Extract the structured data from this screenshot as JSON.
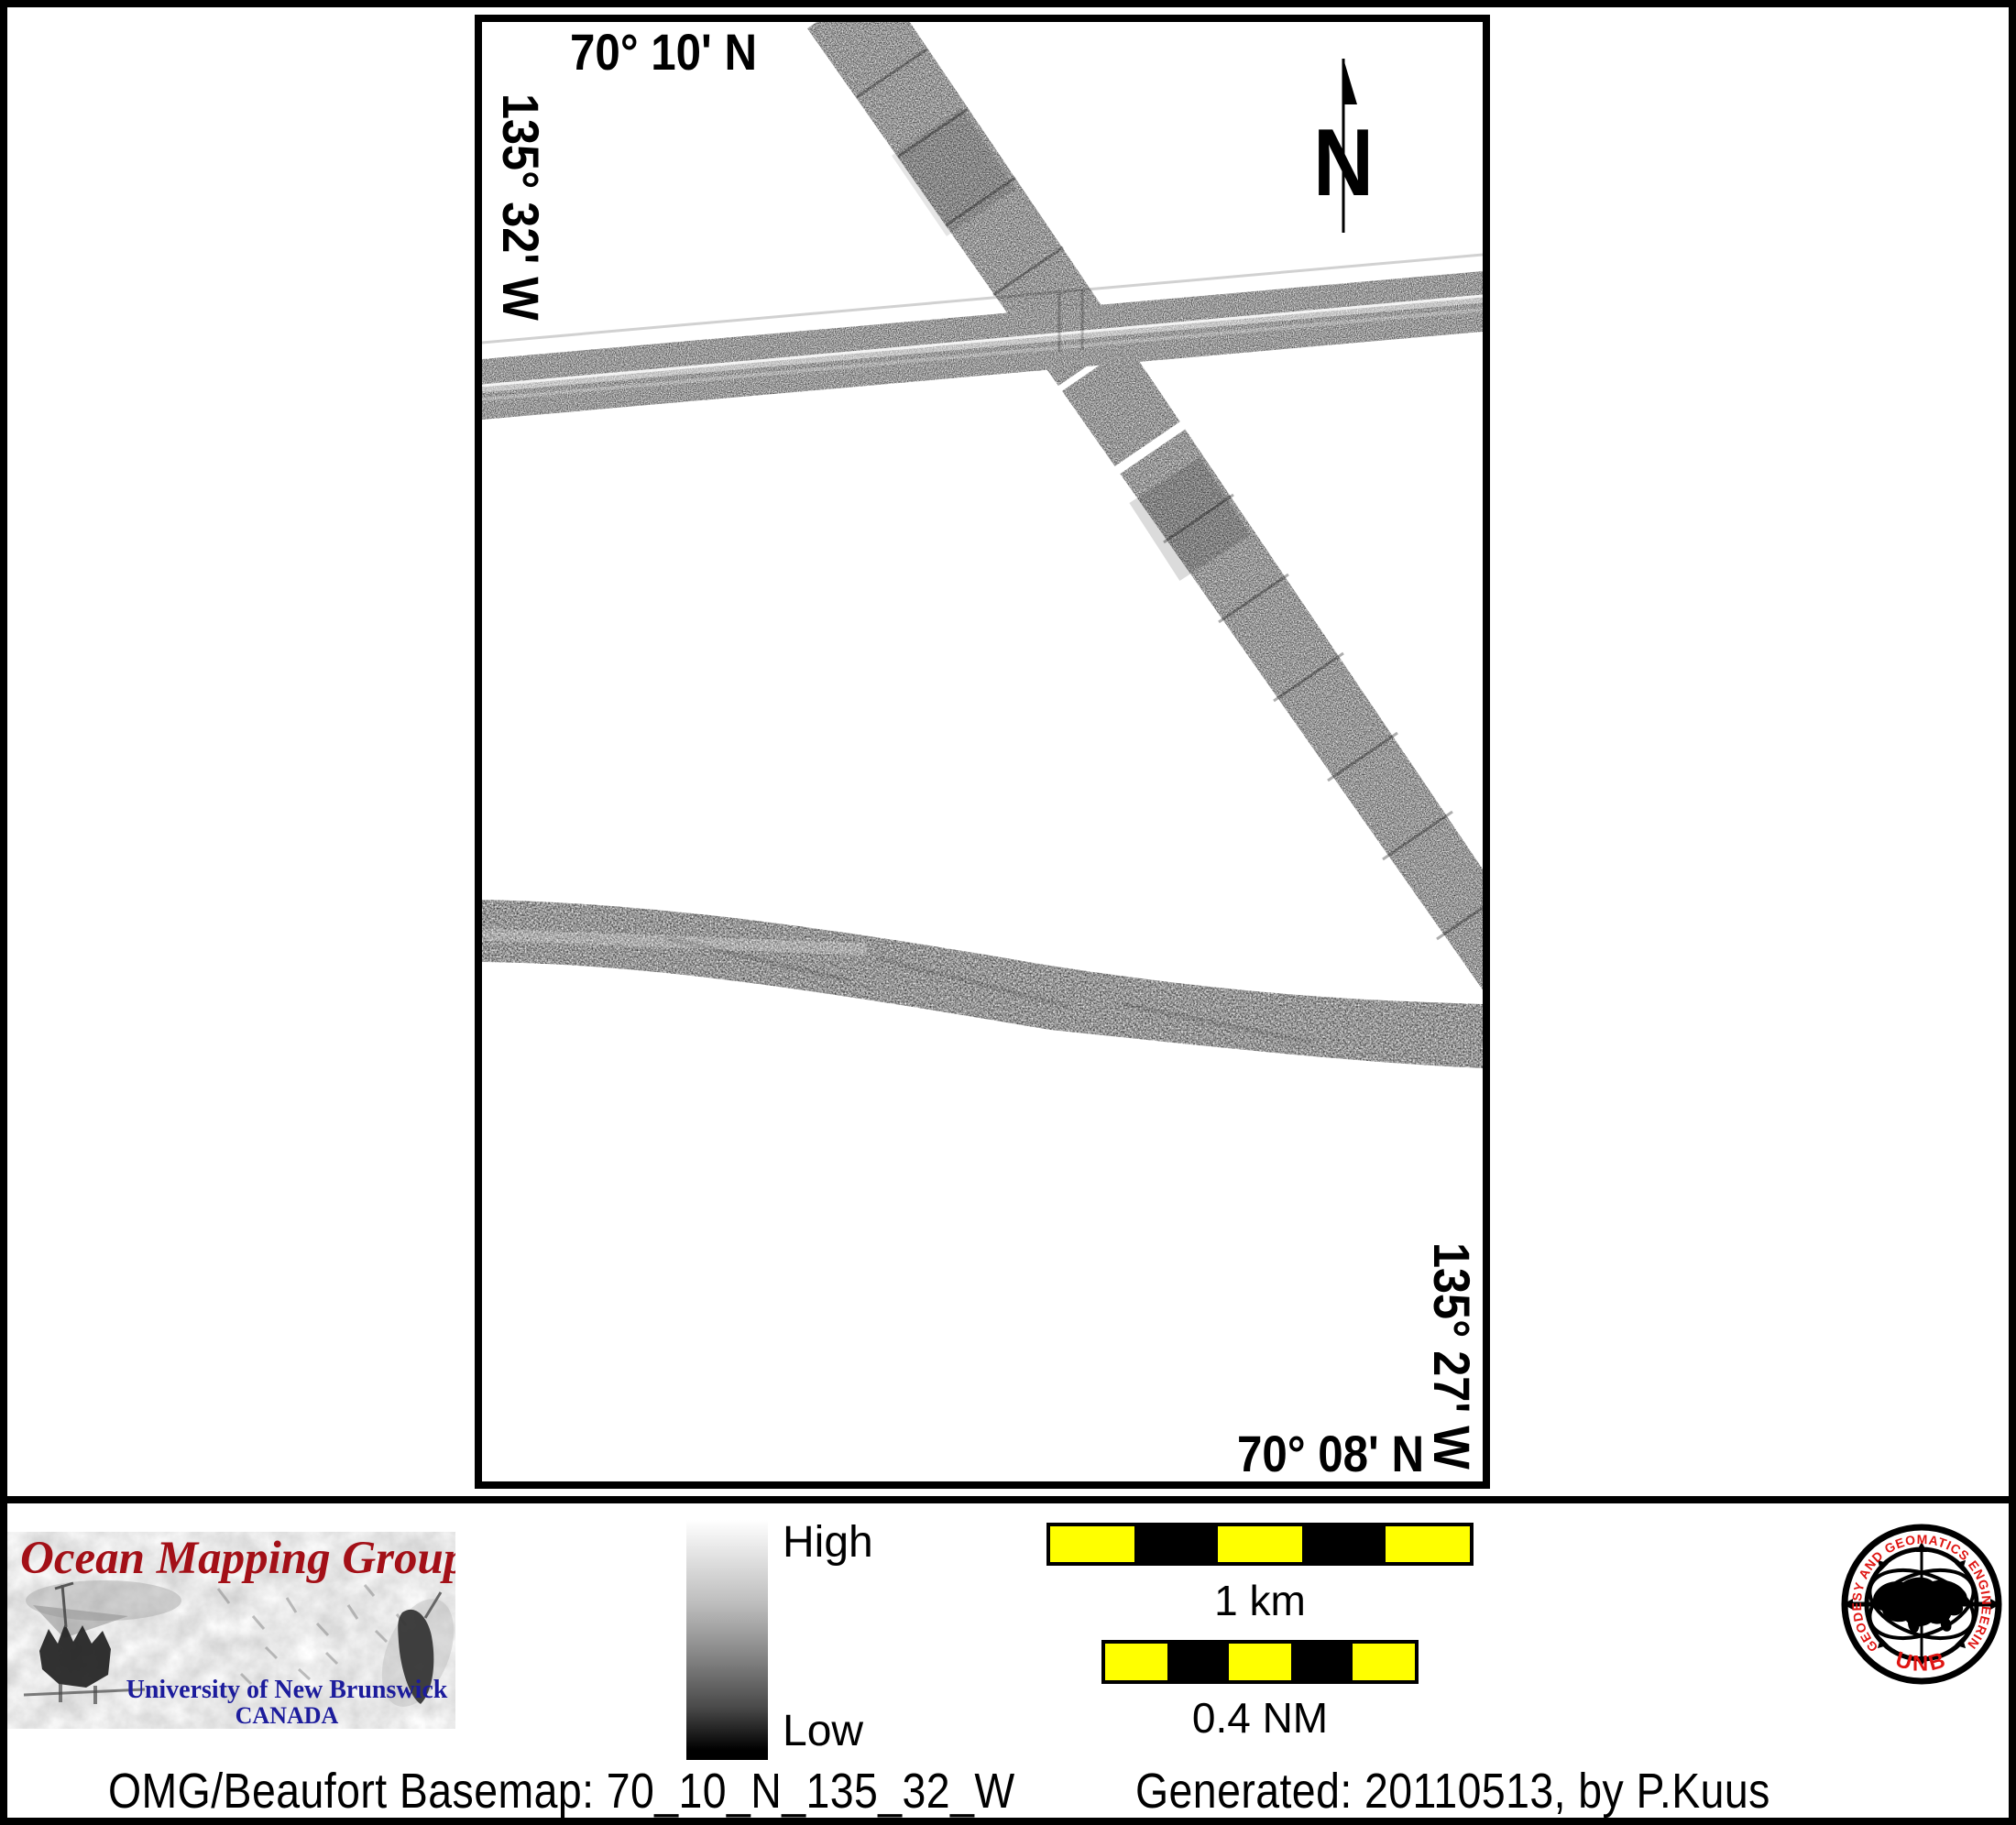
{
  "map": {
    "top_coordinate": "70° 10' N",
    "left_coordinate": "135° 32' W",
    "right_coordinate": "135° 27' W",
    "bottom_coordinate": "70° 08' N",
    "compass_label": "N"
  },
  "legend": {
    "high_label": "High",
    "low_label": "Low",
    "colorbar_high_color": "#ffffff",
    "colorbar_low_color": "#000000",
    "scale_km_label": "1 km",
    "scale_nm_label": "0.4 NM",
    "scalebar_yellow": "#ffff00",
    "scalebar_black": "#000000"
  },
  "omg_logo": {
    "title": "Ocean Mapping Group",
    "university": "University of New Brunswick",
    "country": "CANADA",
    "title_color": "#a31017",
    "university_color": "#1c1c9c"
  },
  "unb_seal": {
    "ring_text": "GEODESY AND GEOMATICS ENGINEERING",
    "acronym": "UNB",
    "text_color": "#df1512"
  },
  "footer": {
    "basemap_text": "OMG/Beaufort Basemap: 70_10_N_135_32_W",
    "generated_text": "Generated: 20110513, by P.Kuus"
  }
}
